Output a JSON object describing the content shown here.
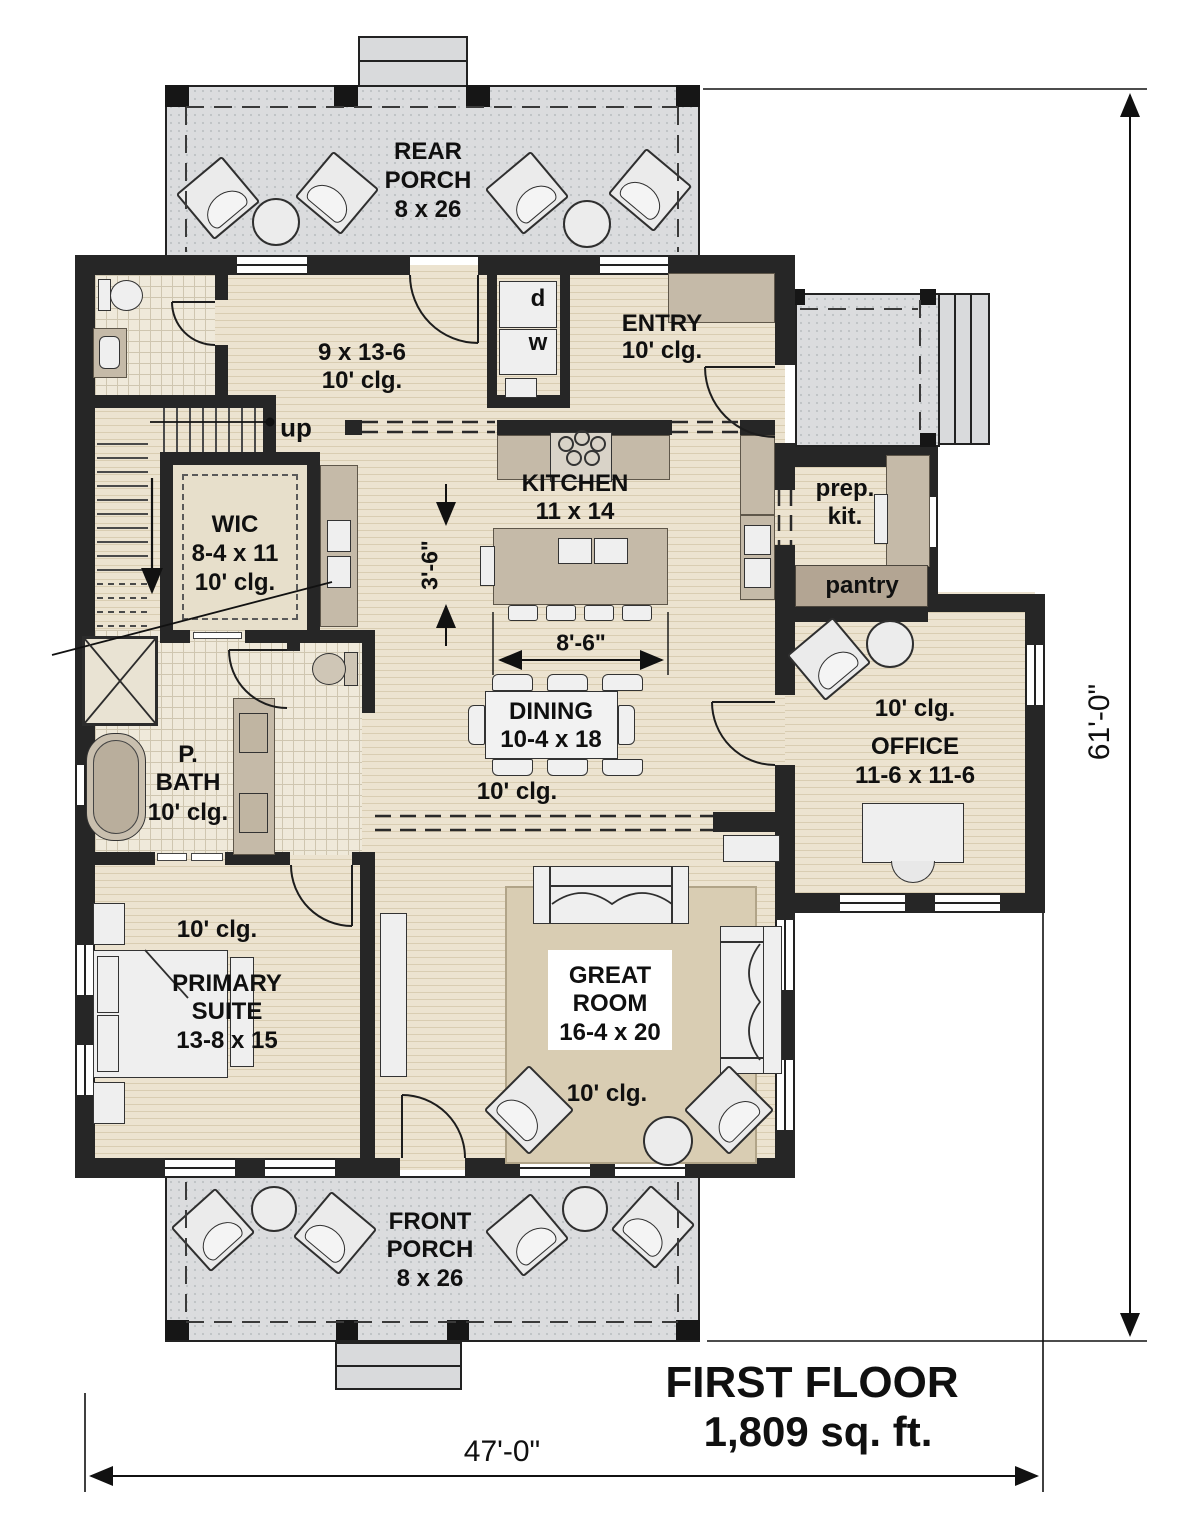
{
  "title_block": {
    "floor": "FIRST FLOOR",
    "area": "1,809 sq. ft."
  },
  "dimensions": {
    "overall_width": "47'-0\"",
    "overall_depth": "61'-0\"",
    "kitchen_clearance": "3'-6\"",
    "island_length": "8'-6\""
  },
  "annotations": {
    "stairs_up": "up",
    "dryer": "d",
    "washer": "w"
  },
  "rooms": {
    "rear_porch": {
      "line1": "REAR",
      "line2": "PORCH",
      "size": "8 x 26"
    },
    "front_porch": {
      "line1": "FRONT",
      "line2": "PORCH",
      "size": "8 x 26"
    },
    "mud_hall": {
      "size": "9 x 13-6",
      "ceiling": "10' clg."
    },
    "entry": {
      "name": "ENTRY",
      "ceiling": "10' clg."
    },
    "kitchen": {
      "name": "KITCHEN",
      "size": "11 x 14"
    },
    "prep_kitchen": {
      "line1": "prep.",
      "line2": "kit."
    },
    "pantry": {
      "name": "pantry"
    },
    "wic": {
      "name": "WIC",
      "size": "8-4 x 11",
      "ceiling": "10' clg."
    },
    "dining": {
      "name": "DINING",
      "size": "10-4 x 18",
      "ceiling": "10' clg."
    },
    "office": {
      "name": "OFFICE",
      "size": "11-6 x 11-6",
      "ceiling": "10' clg."
    },
    "primary_bath": {
      "line1": "P.",
      "line2": "BATH",
      "ceiling": "10' clg."
    },
    "primary_suite": {
      "line1": "PRIMARY",
      "line2": "SUITE",
      "size": "13-8 x 15",
      "ceiling": "10' clg."
    },
    "great_room": {
      "line1": "GREAT",
      "line2": "ROOM",
      "size": "16-4 x 20",
      "ceiling": "10' clg."
    }
  }
}
